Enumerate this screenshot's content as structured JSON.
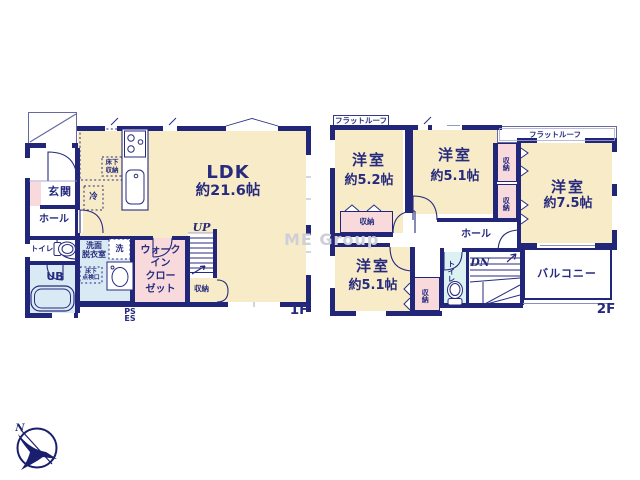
{
  "colors": {
    "wall": "#222679",
    "floor_beige": "#F8EBC7",
    "closet_pink": "#F8DADC",
    "bath_blue": "#DAEAF5",
    "toilet_cyan": "#DCF2F2",
    "label_text": "#272B7E",
    "watermark_gray": "#CFCFDA"
  },
  "floor1": {
    "label": "1F",
    "ldk": {
      "name": "LDK",
      "size": "約21.6帖"
    },
    "genkan": "玄関",
    "hall": "ホール",
    "toilet": "トイレ",
    "bath": "UB",
    "washroom": [
      "洗面",
      "脱衣室"
    ],
    "laundry": "洗",
    "fridge": "冷",
    "underfloor_storage": [
      "床下",
      "収納"
    ],
    "inspection_hatch": [
      "床下",
      "点検口"
    ],
    "wic": [
      "ウォーク",
      "イン",
      "クロー",
      "ゼット"
    ],
    "storage": "収納",
    "stairs": "UP",
    "ps": "PS",
    "es": "ES"
  },
  "floor2": {
    "label": "2F",
    "rooms": [
      {
        "name": "洋室",
        "size": "約5.2帖"
      },
      {
        "name": "洋室",
        "size": "約5.1帖"
      },
      {
        "name": "洋室",
        "size": "約7.5帖"
      },
      {
        "name": "洋室",
        "size": "約5.1帖"
      }
    ],
    "storage": "収納",
    "hall": "ホール",
    "toilet": "トイレ",
    "stairs": "DN",
    "balcony": "バルコニー",
    "flat_roof": "フラットルーフ"
  },
  "compass": {
    "north": "N"
  },
  "watermark": "ME Group"
}
